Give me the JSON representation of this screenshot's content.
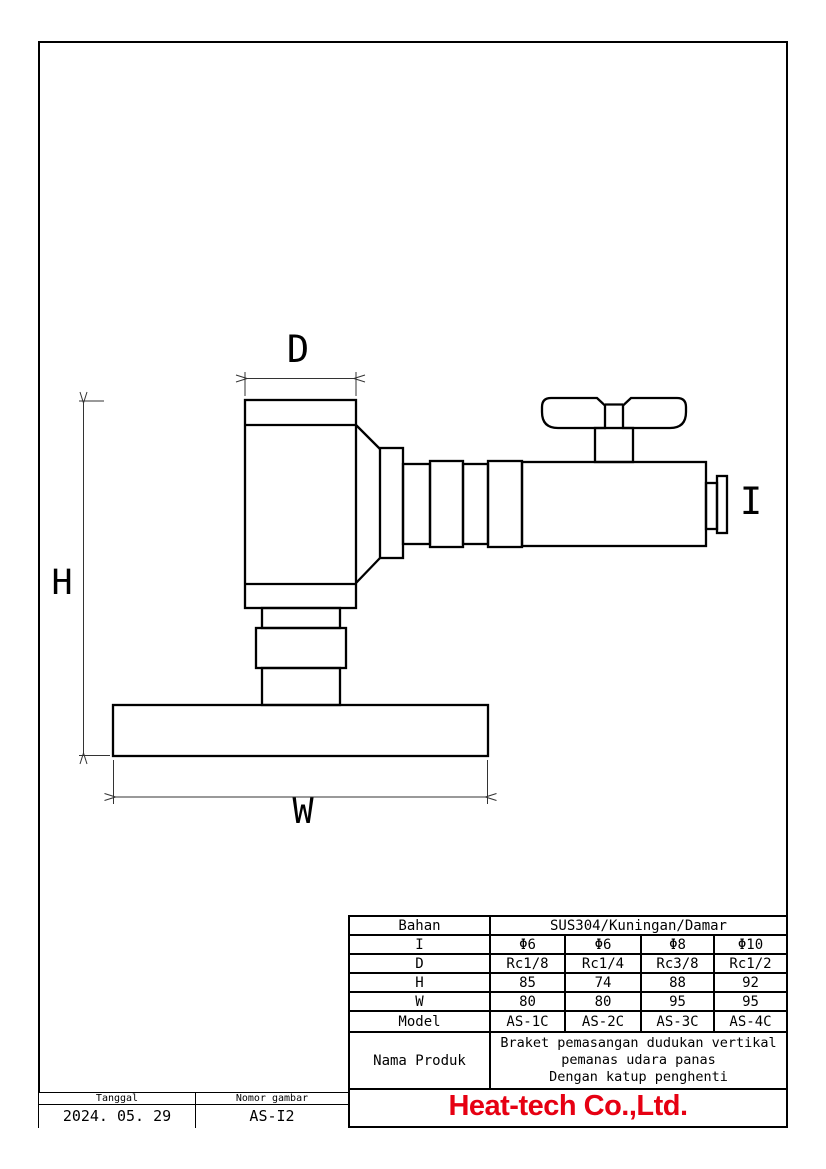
{
  "diagram": {
    "dim_labels": {
      "d": "D",
      "h": "H",
      "w": "W",
      "i": "I"
    }
  },
  "spec_table": {
    "material": {
      "label": "Bahan",
      "value": "SUS304/Kuningan/Damar"
    },
    "rows": [
      {
        "label": "I",
        "values": [
          "Φ6",
          "Φ6",
          "Φ8",
          "Φ10"
        ]
      },
      {
        "label": "D",
        "values": [
          "Rc1/8",
          "Rc1/4",
          "Rc3/8",
          "Rc1/2"
        ]
      },
      {
        "label": "H",
        "values": [
          "85",
          "74",
          "88",
          "92"
        ]
      },
      {
        "label": "W",
        "values": [
          "80",
          "80",
          "95",
          "95"
        ]
      },
      {
        "label": "Model",
        "values": [
          "AS-1C",
          "AS-2C",
          "AS-3C",
          "AS-4C"
        ]
      }
    ],
    "product": {
      "label": "Nama Produk",
      "lines": [
        "Braket pemasangan dudukan vertikal",
        "pemanas udara panas",
        "Dengan katup penghenti"
      ]
    },
    "company": "Heat-tech Co.,Ltd.",
    "company_color": "#e60012"
  },
  "title_block": {
    "date_label": "Tanggal",
    "date_value": "2024. 05. 29",
    "number_label": "Nomor gambar",
    "number_value": "AS-I2"
  }
}
